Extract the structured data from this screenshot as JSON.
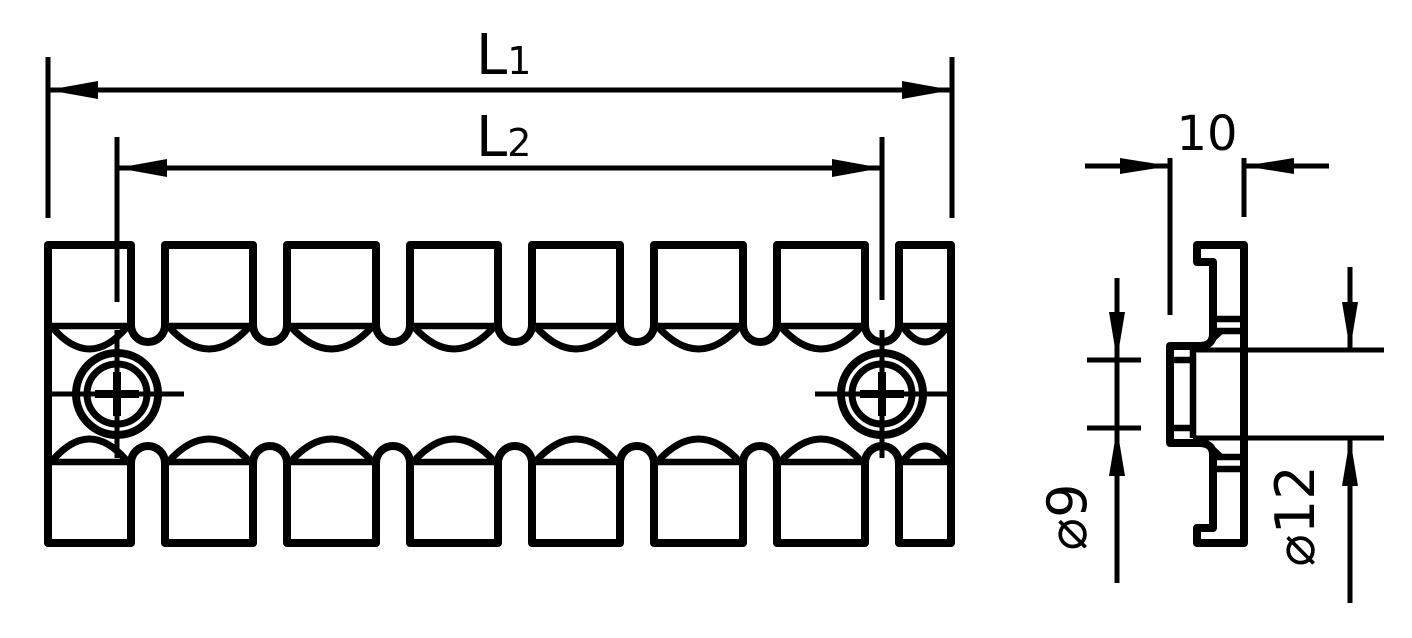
{
  "drawing": {
    "colors": {
      "ink": "#000000",
      "paper": "#ffffff"
    },
    "front_view": {
      "dim_l1": {
        "base": "L",
        "sub": "1"
      },
      "dim_l2": {
        "base": "L",
        "sub": "2"
      }
    },
    "side_view": {
      "dim_width": "10",
      "dim_inner_diameter": {
        "symbol": "⌀",
        "value": "9"
      },
      "dim_outer_diameter": {
        "symbol": "⌀",
        "value": "12"
      }
    }
  }
}
